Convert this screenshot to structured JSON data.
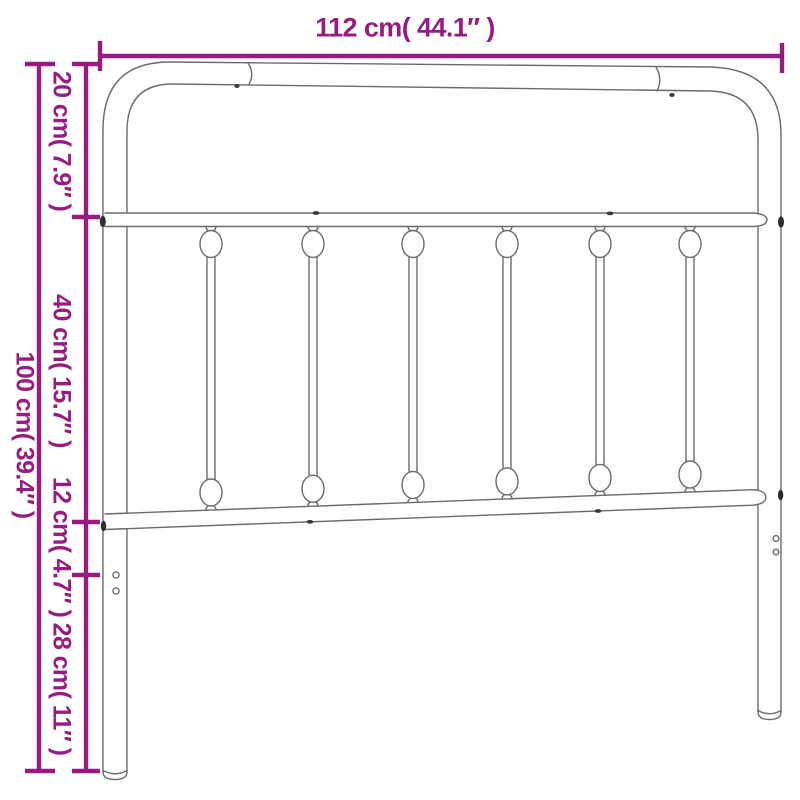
{
  "image": {
    "subject": "metal headboard with rounded top corners and six vertical spindles"
  },
  "colors": {
    "dimension_accent": "#981c80",
    "outline_gray": "#6b6b6b",
    "background": "#ffffff"
  },
  "dimensions": {
    "top_width": "112 cm( 44.1″ )",
    "overall_height": "100 cm( 39.4″ )",
    "segments": [
      "20 cm( 7.9″ )",
      "40 cm( 15.7″ )",
      "12 cm( 4.7″ )",
      "28 cm( 11″ )"
    ]
  }
}
